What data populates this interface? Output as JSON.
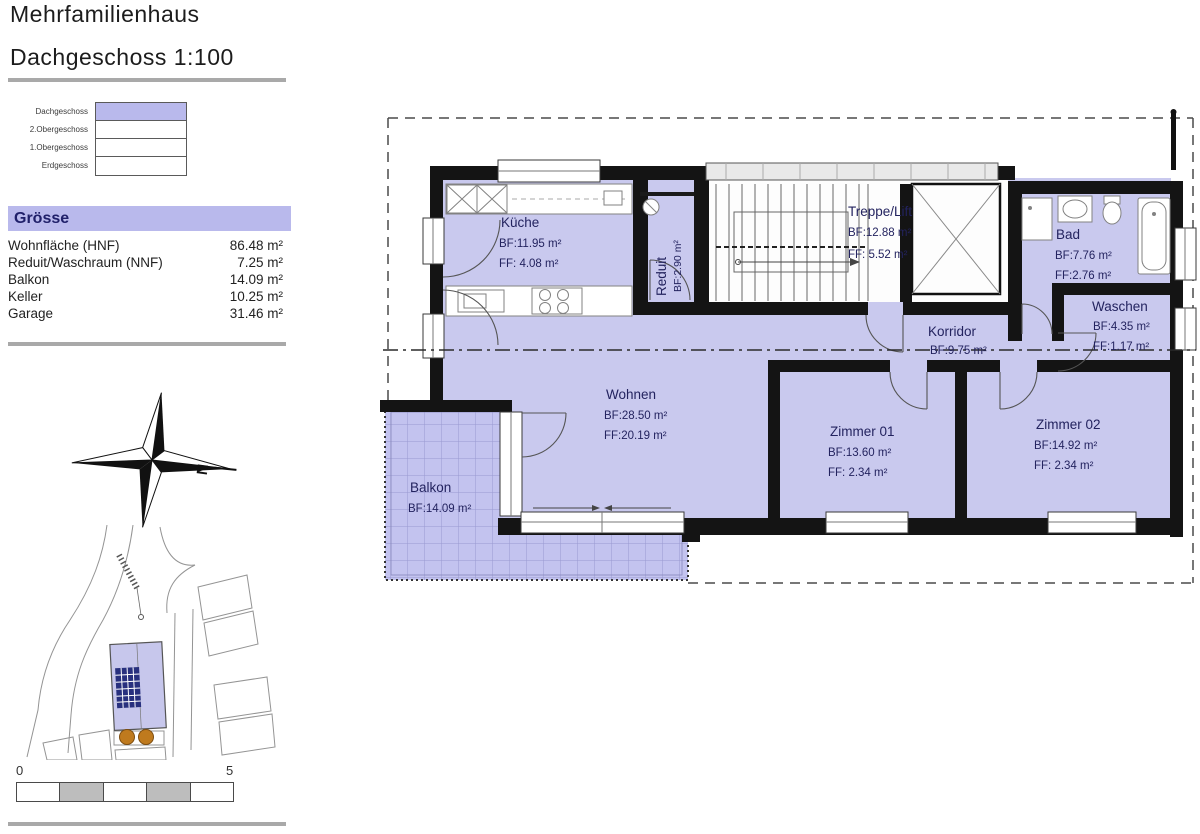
{
  "header": {
    "title": "Mehrfamilienhaus",
    "subtitle": "Dachgeschoss 1:100"
  },
  "floor_selector": {
    "items": [
      {
        "label": "Dachgeschoss",
        "active": true
      },
      {
        "label": "2.Obergeschoss",
        "active": false
      },
      {
        "label": "1.Obergeschoss",
        "active": false
      },
      {
        "label": "Erdgeschoss",
        "active": false
      }
    ]
  },
  "size_panel": {
    "title": "Grösse",
    "rows": [
      {
        "label": "Wohnfläche  (HNF)",
        "value": "86.48 m²"
      },
      {
        "label": "Reduit/Waschraum  (NNF)",
        "value": "7.25 m²"
      },
      {
        "label": "Balkon",
        "value": "14.09 m²"
      },
      {
        "label": "Keller",
        "value": "10.25 m²"
      },
      {
        "label": "Garage",
        "value": "31.46 m²"
      }
    ]
  },
  "compass": {
    "north_label": "N"
  },
  "scale_bar": {
    "start_label": "0",
    "end_label": "5"
  },
  "plan": {
    "rooms": {
      "kueche": {
        "name": "Küche",
        "bf": "BF:11.95 m²",
        "ff": "FF: 4.08 m²"
      },
      "reduit": {
        "name": "Reduit",
        "bf": "BF:2.90 m²"
      },
      "treppe": {
        "name": "Treppe/Lift",
        "bf": "BF:12.88 m²",
        "ff": "FF: 5.52 m²"
      },
      "bad": {
        "name": "Bad",
        "bf": "BF:7.76 m²",
        "ff": "FF:2.76 m²"
      },
      "waschen": {
        "name": "Waschen",
        "bf": "BF:4.35 m²",
        "ff": "FF:1.17 m²"
      },
      "korridor": {
        "name": "Korridor",
        "bf": "BF:9.75 m²"
      },
      "wohnen": {
        "name": "Wohnen",
        "bf": "BF:28.50 m²",
        "ff": "FF:20.19 m²"
      },
      "zimmer01": {
        "name": "Zimmer 01",
        "bf": "BF:13.60 m²",
        "ff": "FF: 2.34 m²"
      },
      "zimmer02": {
        "name": "Zimmer 02",
        "bf": "BF:14.92 m²",
        "ff": "FF: 2.34 m²"
      },
      "balkon": {
        "name": "Balkon",
        "bf": "BF:14.09 m²"
      }
    }
  },
  "colors": {
    "room_fill": "#c9c9ee",
    "highlight": "#b9b9ec",
    "wall": "#141414",
    "label_text": "#23235f",
    "tree": "#bf7a1e",
    "panel_blue": "#28307e"
  }
}
